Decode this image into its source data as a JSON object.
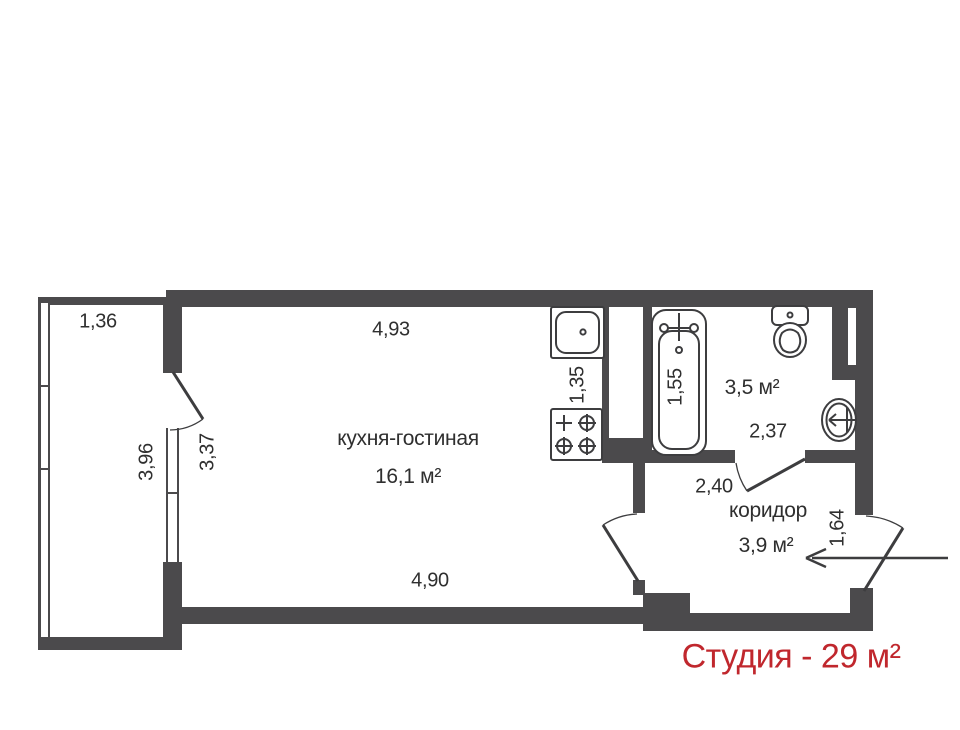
{
  "floorplan": {
    "summary_label": "Студия - 29 м²",
    "rooms": {
      "living": {
        "name": "кухня-гостиная",
        "area": "16,1 м²"
      },
      "bathroom": {
        "area": "3,5 м²"
      },
      "corridor": {
        "name": "коридор",
        "area": "3,9 м²"
      }
    },
    "dimensions": {
      "balcony_width": "1,36",
      "balcony_length": "3,96",
      "living_height": "3,37",
      "living_width_top": "4,93",
      "living_width_bottom": "4,90",
      "kitchen_side": "1,35",
      "bathtub_length": "1,55",
      "bathroom_width": "2,37",
      "corridor_width": "2,40",
      "entry_opening": "1,64"
    },
    "fixtures": [
      "bathtub-icon",
      "toilet-icon",
      "washbasin-icon",
      "kitchen-sink-icon",
      "stove-icon",
      "balcony-door-arc",
      "living-corridor-door-arc",
      "bathroom-door-arc",
      "entry-door-arc",
      "entry-arrow-icon"
    ],
    "colors": {
      "wall": "#4b4a4c",
      "line": "#3d3d3f",
      "text": "#2f2f2f",
      "accent": "#c0272d"
    }
  }
}
